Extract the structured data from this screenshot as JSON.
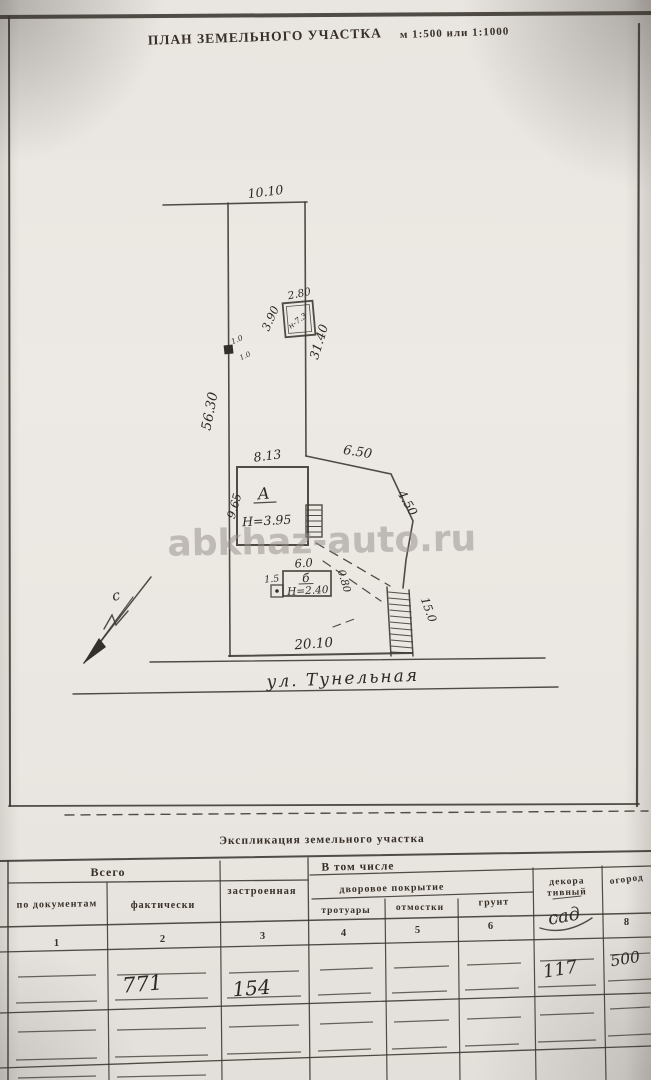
{
  "header": {
    "title": "ПЛАН ЗЕМЕЛЬНОГО УЧАСТКА",
    "scale": "м 1:500 или 1:1000"
  },
  "watermark": "abkhaz-auto.ru",
  "plan": {
    "dim_top": "10.10",
    "dim_left": "56.30",
    "dim_right_upper": "31.40",
    "dim_east1": "6.50",
    "dim_east2": "4.50",
    "dim_bottom": "20.10",
    "shed": {
      "w": "2.80",
      "d": "3.90",
      "label": "н-7.3"
    },
    "well": {
      "a": "1.0",
      "b": "1.0"
    },
    "house": {
      "w": "8.13",
      "d": "9.65",
      "label": "А",
      "height": "Н=3.95"
    },
    "garage": {
      "w": "6.0",
      "label": "б",
      "height": "Н=2.40",
      "annex": "1.5",
      "side": "0.80"
    },
    "stairs": "15.0",
    "street": "ул. Тунельная",
    "north": "с",
    "colors": {
      "house_fill": "#efc4bf",
      "shed_fill": "#ebe4ab",
      "garage_fill": "#ece5b0"
    }
  },
  "table": {
    "title": "Экспликация земельного участка",
    "total": "Всего",
    "including": "В том числе",
    "yard": "дворовое покрытие",
    "cols": {
      "docs": "по документам",
      "fact": "фактически",
      "built": "застроенная",
      "sidewalks": "тротуары",
      "blind_area": "отмостки",
      "soil": "грунт",
      "decor1": "декора",
      "decor2": "тивный",
      "decor_note": "сад",
      "garden": "огород"
    },
    "numbers": [
      "1",
      "2",
      "3",
      "4",
      "5",
      "6",
      "7",
      "8"
    ],
    "values": {
      "fact": "771",
      "built": "154",
      "decor": "117",
      "garden": "500"
    }
  }
}
